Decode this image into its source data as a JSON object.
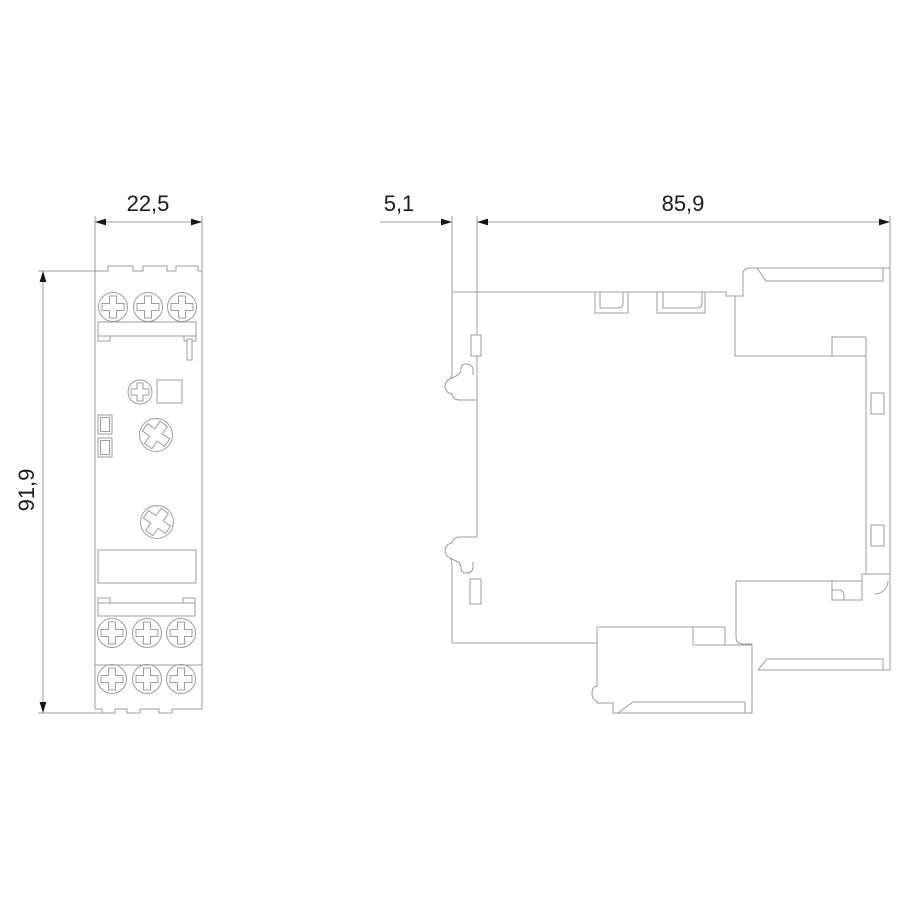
{
  "drawing": {
    "type": "technical-dimension-drawing",
    "views": {
      "front_view": "front outline of DIN-rail device with screw terminals",
      "side_view": "side profile of DIN-rail device"
    },
    "dimensions": {
      "front_width_mm": "22,5",
      "front_height_mm": "91,9",
      "side_flange_depth_mm": "5,1",
      "side_body_depth_mm": "85,9"
    },
    "style": {
      "background": "#ffffff",
      "line_color": "#9c9c9c",
      "text_color": "#1a1a1a",
      "arrow_color": "#161616"
    }
  }
}
